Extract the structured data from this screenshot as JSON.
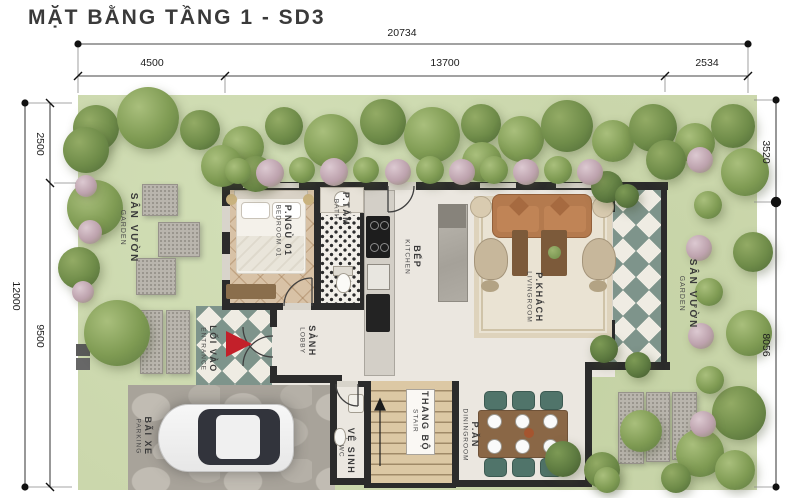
{
  "title": "MẶT BẰNG TẦNG 1 - SD3",
  "dimensions": {
    "top_total": "20734",
    "top_segments": [
      "4500",
      "13700",
      "2534"
    ],
    "left_total": "12000",
    "left_segments": [
      "2500",
      "9500"
    ],
    "right_segments": [
      "3520",
      "8056"
    ]
  },
  "rooms": {
    "garden_left": {
      "vi": "SÂN VƯỜN",
      "en": "GARDEN"
    },
    "garden_right": {
      "vi": "SÂN VƯỜN",
      "en": "GARDEN"
    },
    "bedroom": {
      "vi": "P.NGỦ 01",
      "en": "BEDROOM 01"
    },
    "bath": {
      "vi": "P.TẮM",
      "en": "BATH"
    },
    "kitchen": {
      "vi": "BẾP",
      "en": "KITCHEN"
    },
    "living": {
      "vi": "P.KHÁCH",
      "en": "LIVINGROOM"
    },
    "entrance": {
      "vi": "LỐI VÀO",
      "en": "ENTRANCE"
    },
    "lobby": {
      "vi": "SẢNH",
      "en": "LOBBY"
    },
    "parking": {
      "vi": "BÃI XE",
      "en": "PARKING"
    },
    "wc": {
      "vi": "VỆ SINH",
      "en": "WC"
    },
    "stair": {
      "vi": "THANG BỘ",
      "en": "STAIR"
    },
    "dining": {
      "vi": "P.ĂN",
      "en": "DININGROOM"
    }
  },
  "colors": {
    "lawn": "#cbd7ac",
    "wall": "#2b2b2b",
    "checker_green": "#7e948b",
    "entrance_arrow": "#c3202a",
    "parquet_wood": "#d8c2a6",
    "sofa_brown": "#b47a4e",
    "dining_chair_teal": "#50746a"
  }
}
